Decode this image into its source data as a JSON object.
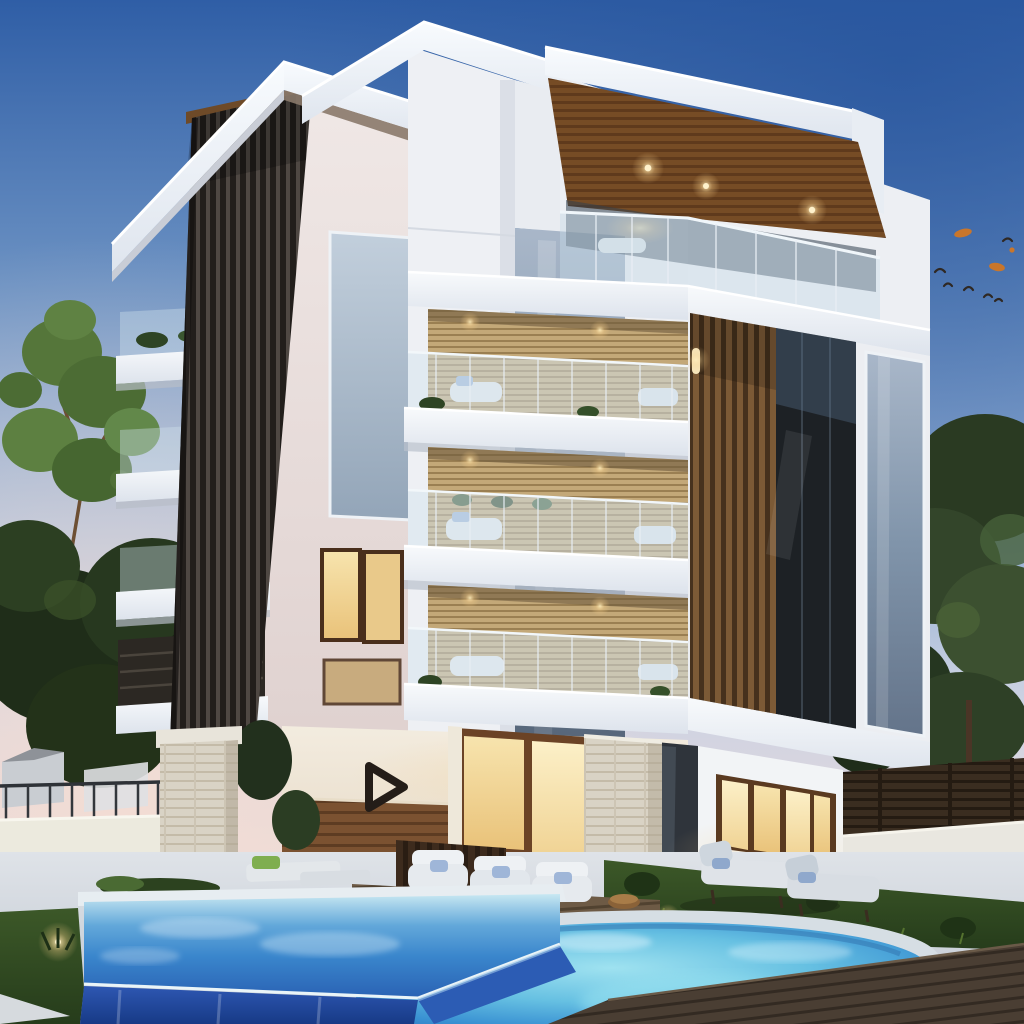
{
  "scene": {
    "type": "architectural_render",
    "time_of_day": "dusk",
    "description": "Photorealistic dusk rendering of a modern five-storey apartment building with stacked white cantilevered balconies, dark vertical louver towers, a timber-soffit penthouse, warm lit interiors, a landscaped garden and a two-level blue swimming pool with infinity edge, wooden deck, sun loungers, trees and a flock of birds in a blue-to-pink gradient sky.",
    "labels": {
      "sky": "dusk gradient sky",
      "birds": "flock of birds with drifting autumn leaves",
      "left_tree": "green tree at left",
      "dark_foliage": "dark evergreen trees behind the left boundary wall",
      "pine_trunk": "pine tree trunk",
      "right_trees": "trees behind the right garden fence",
      "distant_house": "neighbouring house in the distance",
      "building": "modern apartment building",
      "left_tower": "left tower with dark vertical louver cladding",
      "center_tower": "central white core with grey glazed column",
      "right_tower": "right tower with penthouse and stacked balconies",
      "roof": "white cantilevered roof slabs",
      "wood_soffit": "timber roof soffit with warm downlights",
      "penthouse": "glass-railed penthouse terrace",
      "balconies": "three stacked balconies with glass railings",
      "louver_column": "brown timber louver column",
      "dark_window": "full-height dark glazing",
      "ground_floor": "ground floor with timber wainscot and emblem",
      "logo": "dark triangular emblem on the entrance wall",
      "picture_window": "warm lit ground-floor window",
      "stone_pillar": "travertine stone pillar",
      "pool_left": "upper infinity pool with blue spill wall",
      "pool_right": "lower rounded pool",
      "deck": "dark timber pool deck",
      "garden": "lawn with landscape lights and lounge furniture",
      "boundary_walls": "white garden walls with timber fence panels"
    }
  },
  "colors": {
    "sky_top": "#2f5ea6",
    "sky_mid": "#a6bedd",
    "sky_horizon": "#f3e4da",
    "roof_white": "#f5f8fb",
    "louver_dark": "#2b2622",
    "louver_brown": "#7d5a35",
    "soffit_wood": "#8a5a2e",
    "blinds_tan": "#b89c6e",
    "glass_grey": "#9fb2c6",
    "window_warm": "#f6e0a6",
    "wall_cream": "#f0e9dc",
    "wainscot_wood": "#7c5433",
    "stone": "#dcd6c8",
    "pool_deep": "#2a62b4",
    "pool_aqua": "#7cc8e6",
    "pool_wall": "#2c55b0",
    "deck_wood": "#4a3e33",
    "grass": "#35511f",
    "foliage_dark": "#273a1f",
    "tree_green": "#5f8243",
    "leaf_orange": "#c9762b"
  },
  "logo": {
    "glyph": "play-triangle-outline",
    "color": "#241d18"
  },
  "counts": {
    "balcony_levels": 3,
    "pools": 2,
    "birds": 12,
    "soffit_downlights": 3,
    "loungers": 4
  }
}
